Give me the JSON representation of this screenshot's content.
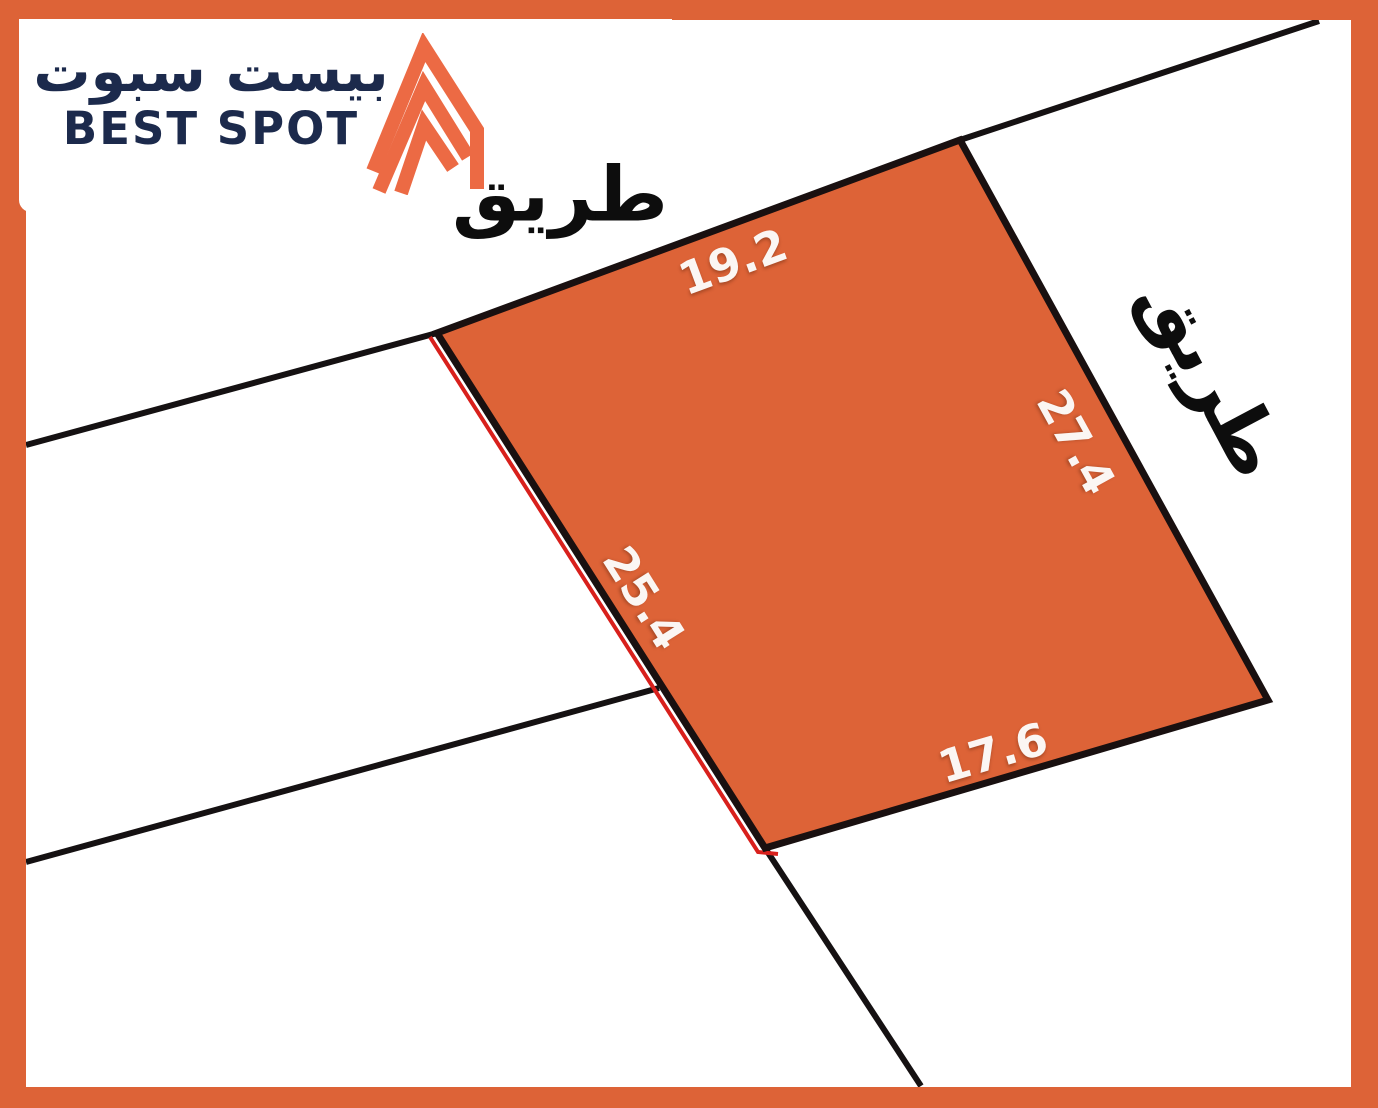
{
  "map": {
    "type": "land-parcel-diagram",
    "parcel": {
      "fill_color": "#dd6337",
      "outline_color": "#191010",
      "highlight_edge_color": "#d8201c",
      "side_lengths": {
        "top": "19.2",
        "right": "27.4",
        "bottom": "17.6",
        "left": "25.4"
      }
    },
    "roads": {
      "top_label": "طريق",
      "right_label": "طريق"
    }
  },
  "logo": {
    "name_ar": "بيست سبوت",
    "name_en": "BEST SPOT",
    "text_color": "#1c2a4c",
    "icon": "double-chevron-building",
    "icon_color": "#ec6a44"
  },
  "colors": {
    "frame": "#dd6337",
    "background": "#ffffff",
    "boundary_lines": "#151112"
  }
}
